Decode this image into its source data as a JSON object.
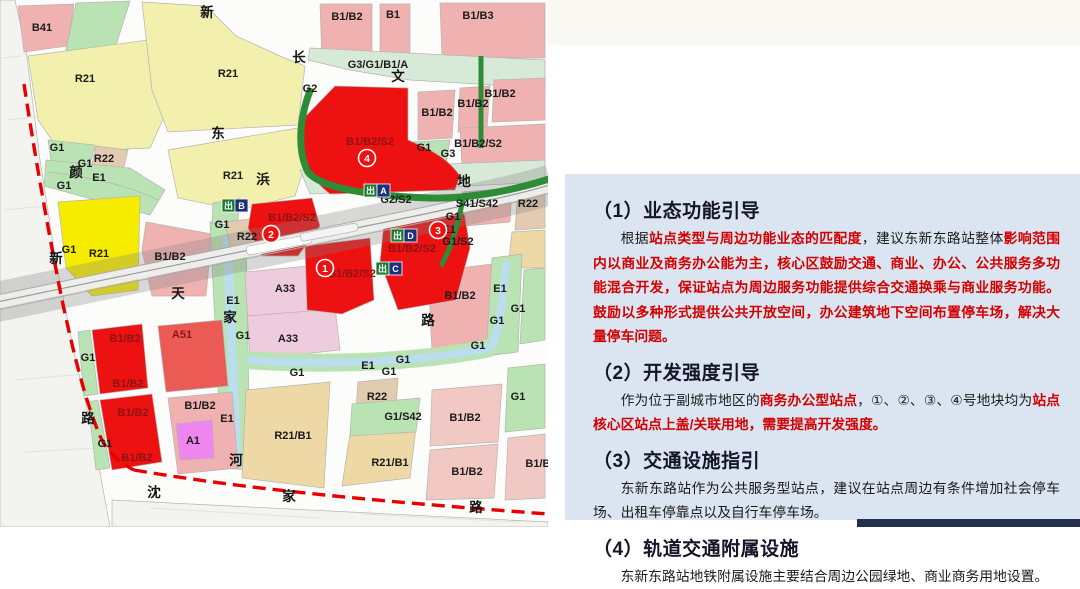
{
  "map": {
    "street_labels": [
      {
        "t": "新",
        "x": 207,
        "y": 17
      },
      {
        "t": "长",
        "x": 299,
        "y": 62
      },
      {
        "t": "文",
        "x": 398,
        "y": 81
      },
      {
        "t": "东",
        "x": 218,
        "y": 138
      },
      {
        "t": "浜",
        "x": 263,
        "y": 184
      },
      {
        "t": "地",
        "x": 464,
        "y": 186
      },
      {
        "t": "颜",
        "x": 76,
        "y": 177
      },
      {
        "t": "新",
        "x": 56,
        "y": 263
      },
      {
        "t": "天",
        "x": 178,
        "y": 298
      },
      {
        "t": "家",
        "x": 230,
        "y": 322
      },
      {
        "t": "河",
        "x": 236,
        "y": 465
      },
      {
        "t": "路",
        "x": 88,
        "y": 423
      },
      {
        "t": "路",
        "x": 428,
        "y": 325
      },
      {
        "t": "沈",
        "x": 154,
        "y": 497
      },
      {
        "t": "家",
        "x": 289,
        "y": 501
      },
      {
        "t": "路",
        "x": 476,
        "y": 512
      }
    ],
    "parcel_labels": [
      {
        "t": "B41",
        "x": 42,
        "y": 31
      },
      {
        "t": "R21",
        "x": 85,
        "y": 82
      },
      {
        "t": "R21",
        "x": 228,
        "y": 77
      },
      {
        "t": "R21",
        "x": 233,
        "y": 179
      },
      {
        "t": "B1/B2",
        "x": 347,
        "y": 20
      },
      {
        "t": "B1",
        "x": 393,
        "y": 18
      },
      {
        "t": "B1/B3",
        "x": 478,
        "y": 19
      },
      {
        "t": "G3/G1/B1/A",
        "x": 378,
        "y": 68
      },
      {
        "t": "G2",
        "x": 310,
        "y": 92
      },
      {
        "t": "G1",
        "x": 57,
        "y": 151
      },
      {
        "t": "R22",
        "x": 104,
        "y": 162
      },
      {
        "t": "G1",
        "x": 85,
        "y": 167
      },
      {
        "t": "E1",
        "x": 99,
        "y": 181
      },
      {
        "t": "G1",
        "x": 64,
        "y": 189
      },
      {
        "t": "G1",
        "x": 69,
        "y": 253
      },
      {
        "t": "R21",
        "x": 99,
        "y": 257
      },
      {
        "t": "B1/B2",
        "x": 170,
        "y": 260
      },
      {
        "t": "B1/B2",
        "x": 437,
        "y": 116
      },
      {
        "t": "B1/B2",
        "x": 473,
        "y": 107
      },
      {
        "t": "B1/B2",
        "x": 500,
        "y": 97
      },
      {
        "t": "B1/B2/S2",
        "x": 478,
        "y": 147
      },
      {
        "t": "G1",
        "x": 424,
        "y": 151
      },
      {
        "t": "G3",
        "x": 448,
        "y": 157
      },
      {
        "t": "B1/B2/S2",
        "x": 370,
        "y": 145,
        "on_red": true
      },
      {
        "t": "G2/S2",
        "x": 396,
        "y": 203
      },
      {
        "t": "S41/S42",
        "x": 477,
        "y": 207
      },
      {
        "t": "R22",
        "x": 528,
        "y": 207
      },
      {
        "t": "G1",
        "x": 453,
        "y": 220
      },
      {
        "t": "E1",
        "x": 449,
        "y": 233
      },
      {
        "t": "G1/S2",
        "x": 458,
        "y": 245
      },
      {
        "t": "G1",
        "x": 222,
        "y": 228
      },
      {
        "t": "R22",
        "x": 247,
        "y": 240
      },
      {
        "t": "B1/B2/S2",
        "x": 292,
        "y": 221,
        "on_red": true
      },
      {
        "t": "B1/B2/S2",
        "x": 412,
        "y": 252,
        "on_red": true
      },
      {
        "t": "B1/B2/S2",
        "x": 352,
        "y": 277,
        "on_red": true
      },
      {
        "t": "A33",
        "x": 285,
        "y": 292
      },
      {
        "t": "A33",
        "x": 288,
        "y": 342
      },
      {
        "t": "E1",
        "x": 233,
        "y": 304
      },
      {
        "t": "G1",
        "x": 243,
        "y": 339
      },
      {
        "t": "G1",
        "x": 297,
        "y": 376
      },
      {
        "t": "E1",
        "x": 227,
        "y": 422
      },
      {
        "t": "B1/B2",
        "x": 460,
        "y": 299
      },
      {
        "t": "E1",
        "x": 500,
        "y": 292
      },
      {
        "t": "G1",
        "x": 518,
        "y": 312
      },
      {
        "t": "G1",
        "x": 497,
        "y": 324
      },
      {
        "t": "G1",
        "x": 478,
        "y": 349
      },
      {
        "t": "E1",
        "x": 368,
        "y": 369
      },
      {
        "t": "G1",
        "x": 403,
        "y": 363
      },
      {
        "t": "G1",
        "x": 389,
        "y": 375
      },
      {
        "t": "R21/B1",
        "x": 293,
        "y": 439
      },
      {
        "t": "R21/B1",
        "x": 390,
        "y": 466
      },
      {
        "t": "R22",
        "x": 377,
        "y": 400
      },
      {
        "t": "G1/S42",
        "x": 403,
        "y": 420
      },
      {
        "t": "B1/B2",
        "x": 465,
        "y": 421
      },
      {
        "t": "B1/B2",
        "x": 467,
        "y": 475
      },
      {
        "t": "G1",
        "x": 518,
        "y": 400
      },
      {
        "t": "B1/B2",
        "x": 541,
        "y": 467
      },
      {
        "t": "B1/B2",
        "x": 125,
        "y": 342,
        "on_red": true
      },
      {
        "t": "B1/B2",
        "x": 128,
        "y": 387,
        "on_red": true
      },
      {
        "t": "B1/B2",
        "x": 133,
        "y": 416,
        "on_red": true
      },
      {
        "t": "B1/B2",
        "x": 137,
        "y": 461,
        "on_red": true
      },
      {
        "t": "G1",
        "x": 88,
        "y": 361
      },
      {
        "t": "G1",
        "x": 105,
        "y": 447
      },
      {
        "t": "A51",
        "x": 182,
        "y": 338,
        "on_red": true
      },
      {
        "t": "B1/B2",
        "x": 200,
        "y": 409
      },
      {
        "t": "A1",
        "x": 193,
        "y": 444
      }
    ],
    "exits": {
      "char": "出",
      "items": [
        {
          "letter": "A",
          "x": 364,
          "y": 184
        },
        {
          "letter": "B",
          "x": 222,
          "y": 199
        },
        {
          "letter": "C",
          "x": 376,
          "y": 262
        },
        {
          "letter": "D",
          "x": 391,
          "y": 229
        }
      ]
    },
    "markers": [
      {
        "n": "1",
        "x": 325,
        "y": 268
      },
      {
        "n": "2",
        "x": 271,
        "y": 234
      },
      {
        "n": "3",
        "x": 438,
        "y": 230
      },
      {
        "n": "4",
        "x": 367,
        "y": 158
      }
    ],
    "palette": {
      "red_parcel": "#ee1111",
      "pink_parcel": "#f0b2b0",
      "yellow_parcel": "#f3f0ae",
      "bright_yellow": "#f6ec00",
      "green": "#b9e3b2",
      "dark_green": "#2e8b36",
      "canal": "#badeed",
      "tan": "#e2cbb0",
      "khaki": "#eed9a6",
      "boundary_red": "#e60000",
      "exit_green": "#1d7a34",
      "exit_navy": "#1d2f7e"
    }
  },
  "panel": {
    "bg": "#dbe5f1",
    "accent_red": "#d30000",
    "sections": [
      {
        "heading": "（1）业态功能引导",
        "runs": [
          {
            "text": "根据"
          },
          {
            "text": "站点类型与周边功能业态的匹配度",
            "em": true
          },
          {
            "text": "，建议东新东路站整体"
          },
          {
            "text": "影响范围内以商业及商务办公能为主，核心区鼓励交通、商业、办公、公共服务多功能混合开发，保证站点为周边服务功能提供综合交通换乘与商业服务功能。鼓励以多种形式提供公共开放空间，办公建筑地下空间布置停车场，解决大量停车问题。",
            "em": true
          }
        ]
      },
      {
        "heading": "（2）开发强度引导",
        "runs": [
          {
            "text": "作为位于副城市地区的"
          },
          {
            "text": "商务办公型站点",
            "em": true
          },
          {
            "text": "，①、②、③、④号地块均为"
          },
          {
            "text": "站点核心区站点上盖/关联用地，需要提高开发强度。",
            "em": true
          }
        ]
      },
      {
        "heading": "（3）交通设施指引",
        "runs": [
          {
            "text": "东新东路站作为公共服务型站点，建议在站点周边有条件增加社会停车场、出租车停靠点以及自行车停车场。"
          }
        ]
      },
      {
        "heading": "（4）轨道交通附属设施",
        "runs": [
          {
            "text": "东新东路站地铁附属设施主要结合周边公园绿地、商业商务用地设置。"
          }
        ]
      }
    ]
  }
}
